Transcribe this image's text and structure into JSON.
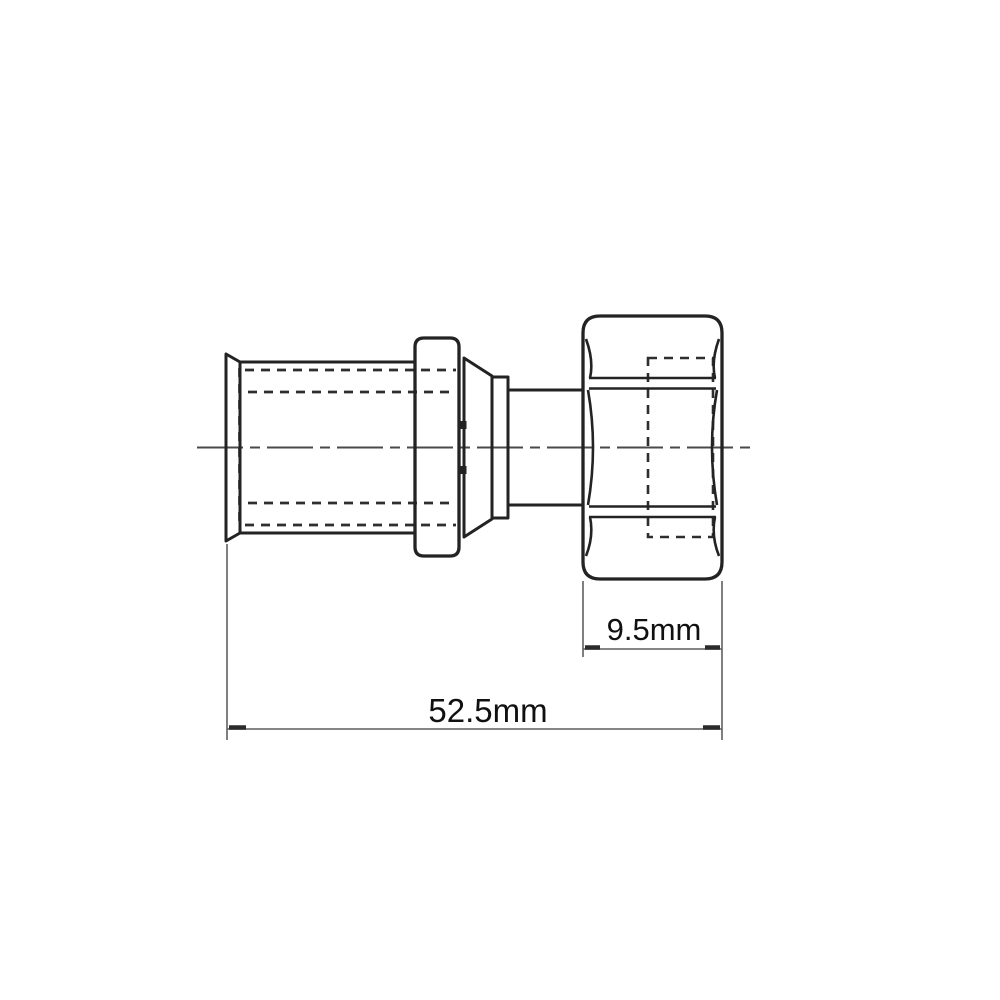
{
  "page": {
    "background": "#ffffff"
  },
  "drawing": {
    "dimension_labels": {
      "nut_width": "9.5mm",
      "overall_length": "52.5mm"
    },
    "colors": {
      "outline": "#232323",
      "hidden_line": "#2e2e2e",
      "centerline": "#4a4a4a",
      "dimension_line": "#5f5f5f",
      "tick": "#2b2b2b",
      "text": "#101010"
    }
  }
}
